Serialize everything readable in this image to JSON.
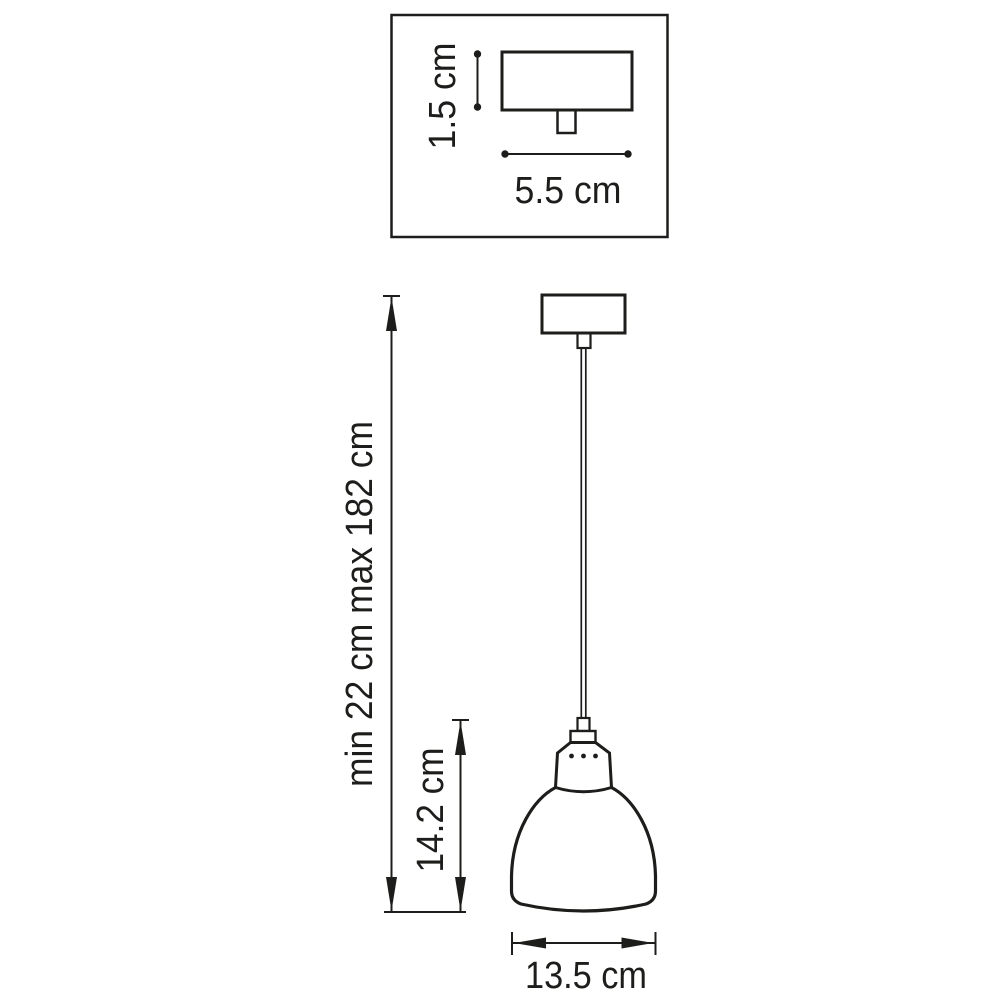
{
  "diagram": {
    "type": "technical-dimension-drawing",
    "subject": "pendant-lamp",
    "labels": {
      "canopy_height": "1.5 cm",
      "canopy_width": "5.5 cm",
      "suspension_height": "min 22 cm max 182 cm",
      "shade_height": "14.2 cm",
      "shade_width": "13.5 cm"
    },
    "colors": {
      "ink": "#1d1d1b",
      "background": "#ffffff"
    }
  }
}
